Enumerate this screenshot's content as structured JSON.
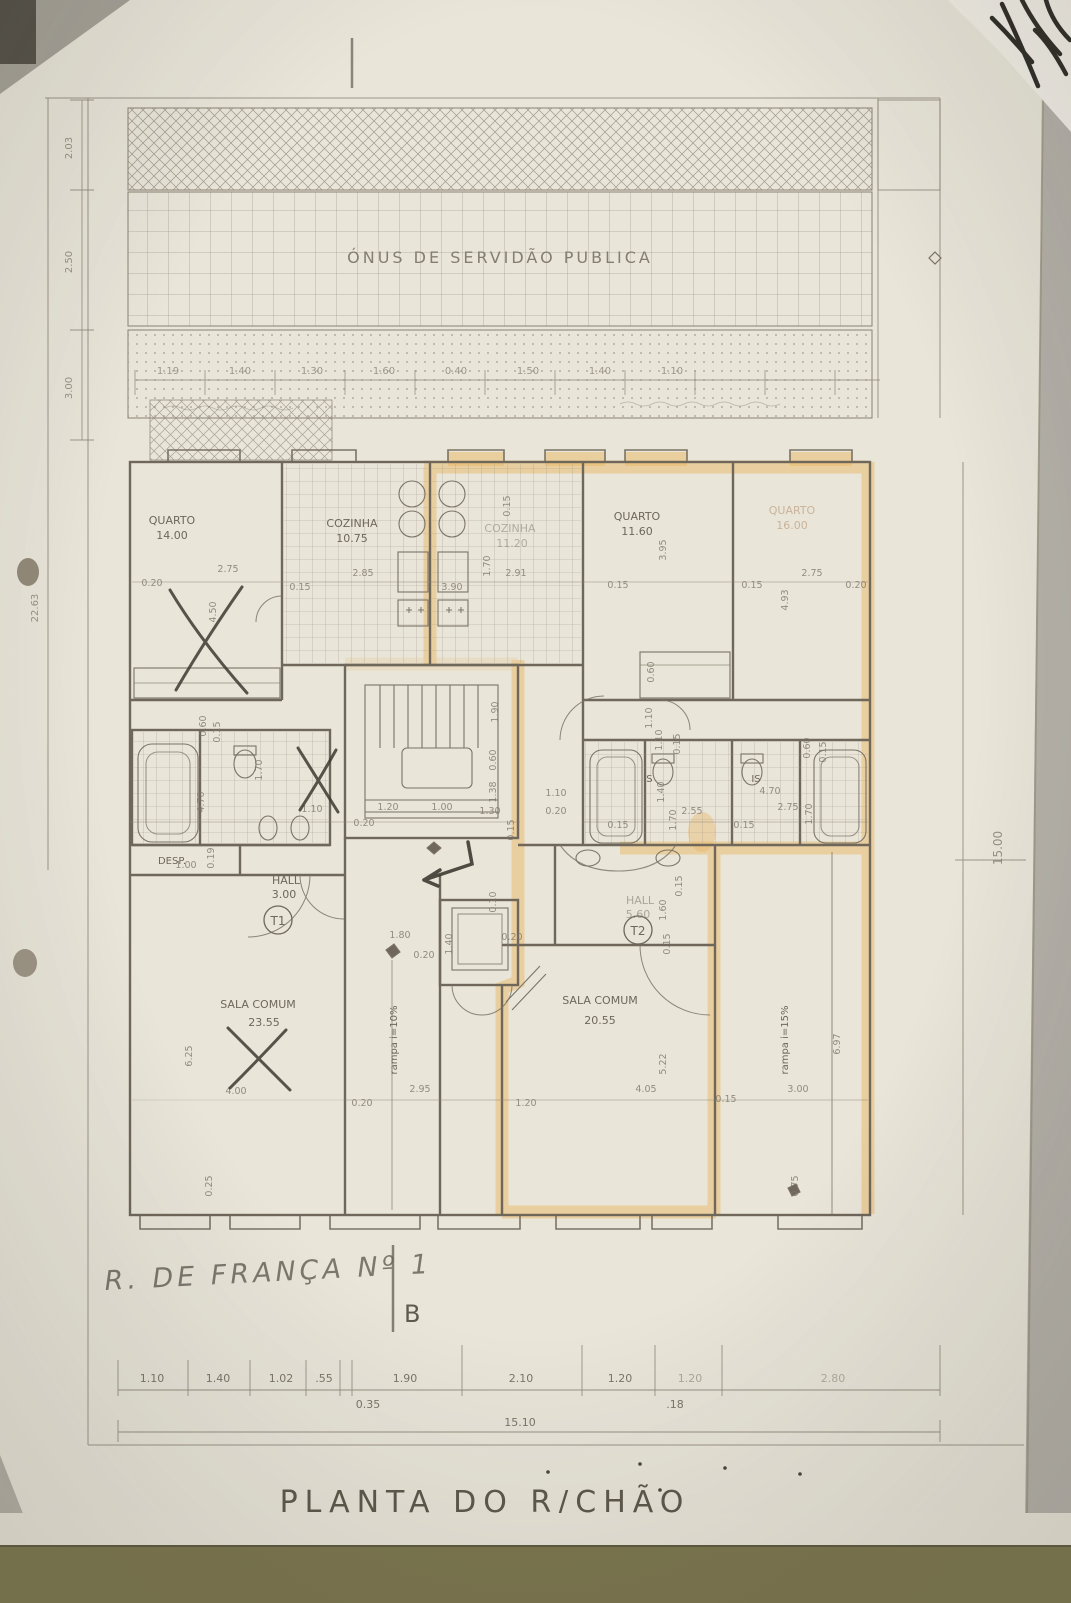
{
  "banner": {
    "text": "ÓNUS DE SERVIDÃO PUBLICA"
  },
  "title": {
    "text": "PLANTA DO R/CHÃO"
  },
  "handwriting": {
    "address": "R. DE FRANÇA Nº 1",
    "section": "B"
  },
  "units": {
    "t1": "T1",
    "t2": "T2"
  },
  "rooms": {
    "quarto1": {
      "name": "QUARTO",
      "area": "14.00"
    },
    "cozinha1": {
      "name": "COZINHA",
      "area": "10.75"
    },
    "cozinha2": {
      "name": "COZINHA",
      "area": "11.20"
    },
    "quarto2": {
      "name": "QUARTO",
      "area": "11.60"
    },
    "quarto3": {
      "name": "QUARTO",
      "area": "16.00"
    },
    "hall1": {
      "name": "HALL",
      "area": "3.00"
    },
    "hall2": {
      "name": "HALL",
      "area": "5.60"
    },
    "desp": {
      "name": "DESP."
    },
    "is1": {
      "name": "IS"
    },
    "is2": {
      "name": "IS"
    },
    "sala1": {
      "name": "SALA COMUM",
      "area": "23.55"
    },
    "sala2": {
      "name": "SALA COMUM",
      "area": "20.55"
    }
  },
  "ramps": {
    "left": "rampa i=10%",
    "right": "rampa i=15%"
  },
  "dims": {
    "left_col": [
      "2.03",
      "2.50",
      "3.00"
    ],
    "left_total": "22.63",
    "right_total": "15.00",
    "top_row": [
      "1.19",
      "1.40",
      "1.30",
      "1.60",
      "0.40",
      "1.50",
      "1.40",
      "1.10"
    ],
    "bottom_row": [
      "1.10",
      "1.40",
      "1.02",
      ".55",
      "1.90",
      "2.10",
      "1.20",
      "1.20",
      "2.80"
    ],
    "bottom_sub": [
      "0.35",
      ".18"
    ],
    "bottom_total": "15.10",
    "interior": [
      "0.20",
      "2.75",
      "4.50",
      "0.15",
      "2.85",
      "3.90",
      "1.70",
      "2.91",
      "0.15",
      "0.15",
      "3.95",
      "0.15",
      "2.75",
      "0.20",
      "4.93",
      "0.60",
      "0.15",
      "1.70",
      "4.70",
      "1.10",
      "0.20",
      "1.90",
      "0.60",
      "1.38",
      "1.20",
      "1.00",
      "1.30",
      "0.15",
      "1.10",
      "0.15",
      "1.40",
      "1.70",
      "2.55",
      "0.15",
      "4.70",
      "2.75",
      "1.70",
      "0.60",
      "0.15",
      "0.15",
      "1.80",
      "0.20",
      "0.15",
      "1.60",
      "0.15",
      "6.25",
      "4.00",
      "1.00",
      "0.19",
      "2.95",
      "0.20",
      "5.22",
      "4.05",
      "1.20",
      "0.15",
      "3.00",
      "6.97",
      "0.75",
      "0.25",
      "1.40",
      "0.10",
      "0.20",
      "1.10",
      "0.20",
      "0.60",
      "1.10"
    ]
  },
  "colors": {
    "paper": "#e9e5d9",
    "ink": "#6f685a",
    "highlighter": "#e9b765",
    "pen": "#3e3a31"
  }
}
